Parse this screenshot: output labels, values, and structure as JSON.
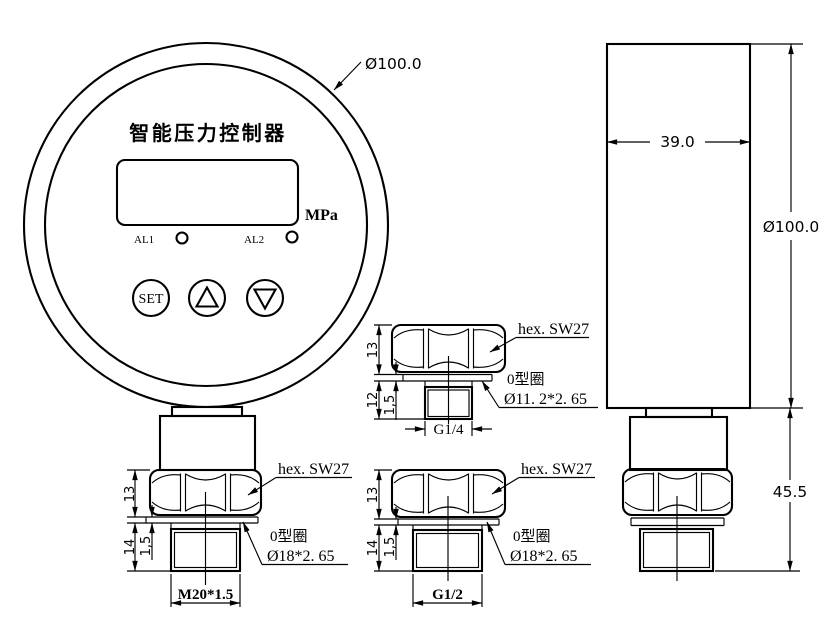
{
  "colors": {
    "line": "#000000",
    "background": "#ffffff"
  },
  "front_view": {
    "product_title": "智能压力控制器",
    "unit_label": "MPa",
    "alarm1_label": "AL1",
    "alarm2_label": "AL2",
    "set_button_label": "SET",
    "outer_diameter_dim": "Ø100.0",
    "hex_height_dim": "13",
    "thread_length_dim": "14",
    "oring_thickness_dim": "1,5",
    "thread_spec_dim": "M20*1.5",
    "hex_label": "hex. SW27",
    "oring_label": "0型圈",
    "oring_spec": "Ø18*2. 65"
  },
  "side_view": {
    "body_width_dim": "39.0",
    "body_diameter_dim": "Ø100.0",
    "stem_length_dim": "45.5"
  },
  "detail_g14": {
    "hex_label": "hex. SW27",
    "oring_label": "0型圈",
    "oring_spec": "Ø11. 2*2. 65",
    "thread_spec_dim": "G1/4",
    "hex_height_dim": "13",
    "thread_length_dim": "12",
    "oring_thickness_dim": "1,5"
  },
  "detail_g12": {
    "hex_label": "hex. SW27",
    "oring_label": "0型圈",
    "oring_spec": "Ø18*2. 65",
    "thread_spec_dim": "G1/2",
    "hex_height_dim": "13",
    "thread_length_dim": "14",
    "oring_thickness_dim": "1,5"
  }
}
